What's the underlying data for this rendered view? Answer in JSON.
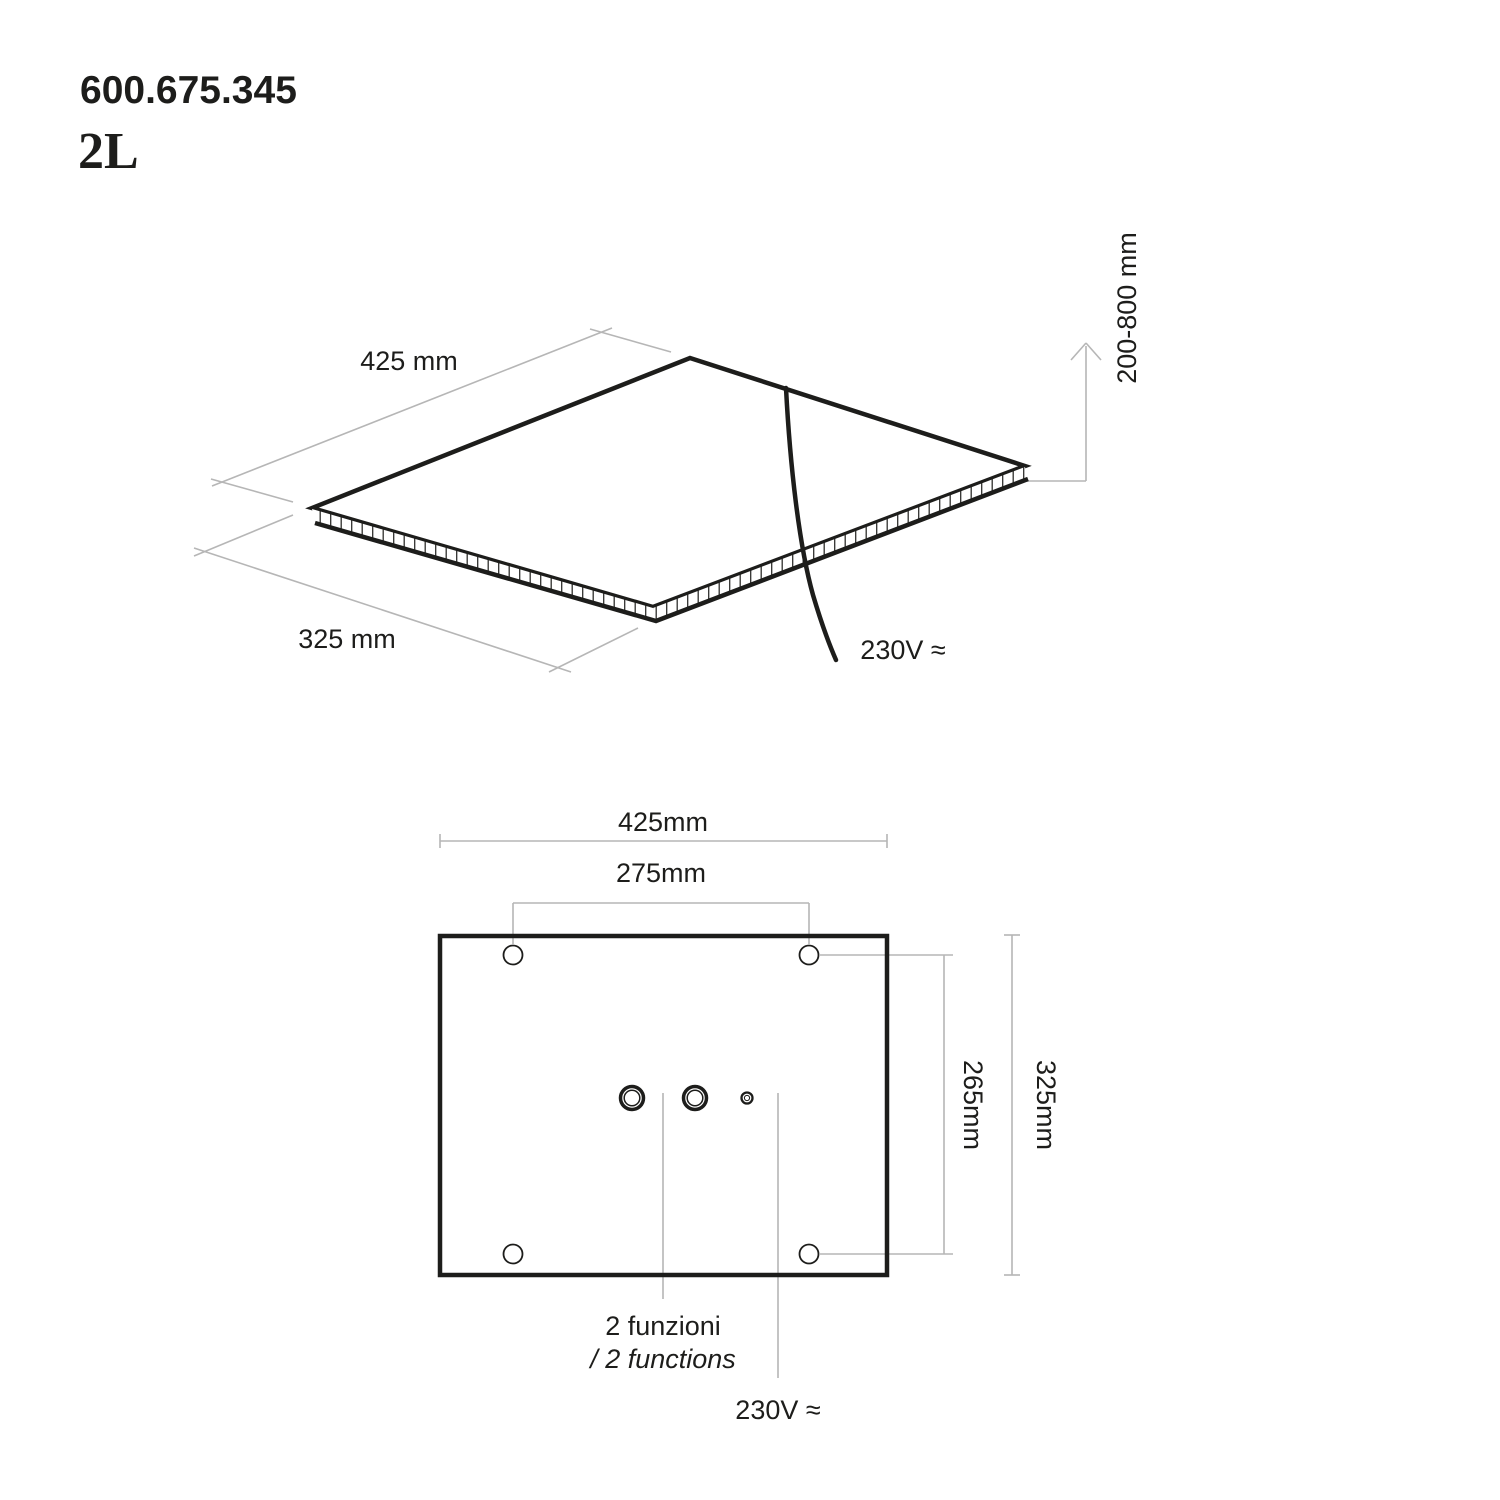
{
  "header": {
    "product_code": "600.675.345",
    "variant": "2L"
  },
  "colors": {
    "ink": "#1d1d1b",
    "dim_line": "#b6b6b6",
    "hatch": "#2f2f2d",
    "background": "#ffffff"
  },
  "iso_view": {
    "width_label": "425 mm",
    "depth_label": "325 mm",
    "height_range_label": "200-800 mm",
    "power_label": "230V ≈"
  },
  "plan_view": {
    "overall_width_label": "425mm",
    "hole_spacing_x_label": "275mm",
    "hole_spacing_y_label": "265mm",
    "overall_height_label": "325mm",
    "functions_label_it": "2 funzioni",
    "functions_label_en": "/ 2 functions",
    "power_label": "230V ≈"
  }
}
